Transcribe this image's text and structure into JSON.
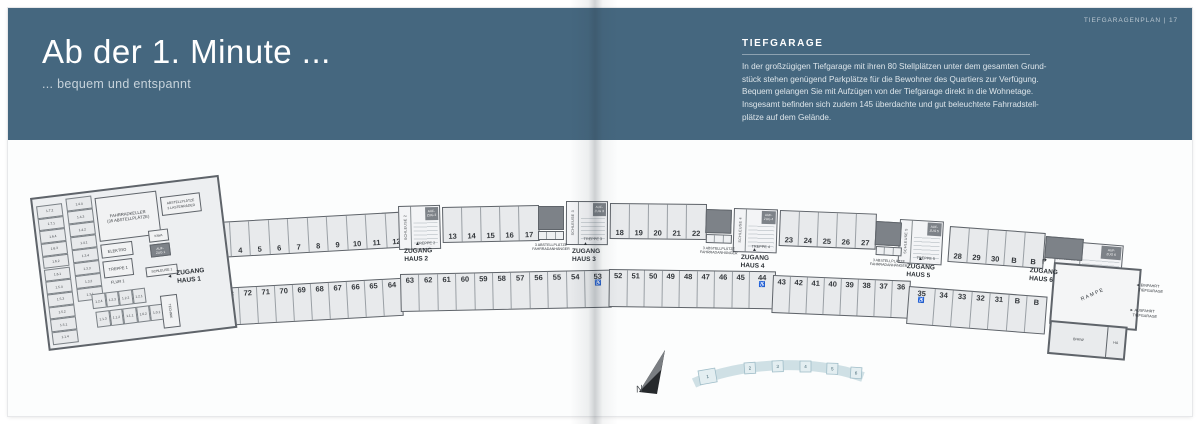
{
  "colors": {
    "header_bg": "#45677f",
    "wall": "#5f646a",
    "stall_fill": "#e8eaec",
    "dark_block": "#7d8288",
    "minimap_fill": "#e3eef1",
    "minimap_border": "#9fbdc8"
  },
  "header_left": {
    "title": "Ab der 1. Minute ...",
    "subtitle": "... bequem und entspannt"
  },
  "header_right": {
    "corner": "TIEFGARAGENPLAN | 17",
    "section_title": "TIEFGARAGE",
    "paragraph": [
      "In der großzügigen Tiefgarage mit ihren 80 Stellplätzen unter dem gesamten Grund-",
      "stück stehen genügend Parkplätze für die Bewohner des Quartiers zur Verfügung.",
      "Bequem gelangen Sie mit Aufzügen von der Tiefgarage direkt in die Wohnetage.",
      "Insgesamt befinden sich zudem 145 überdachte und gut beleuchtete Fahrradstell-",
      "plätze auf dem Gelände."
    ]
  },
  "plan": {
    "handicap": [
      "1",
      "53",
      "44",
      "35"
    ],
    "segments": [
      {
        "row": "top",
        "x": 163,
        "y": 225,
        "h": 36,
        "rot": -3.2,
        "sw": 19.5,
        "stalls": [
          "1",
          "2",
          "3",
          "4",
          "5",
          "6",
          "7",
          "8",
          "9",
          "10",
          "11",
          "12"
        ]
      },
      {
        "row": "top",
        "x": 442,
        "y": 207,
        "h": 36,
        "rot": -1.2,
        "sw": 19,
        "stalls": [
          "13",
          "14",
          "15",
          "16",
          "17"
        ]
      },
      {
        "row": "top",
        "x": 610,
        "y": 203,
        "h": 36,
        "rot": 0.6,
        "sw": 19,
        "stalls": [
          "18",
          "19",
          "20",
          "21",
          "22"
        ]
      },
      {
        "row": "top",
        "x": 780,
        "y": 210,
        "h": 36,
        "rot": 2.2,
        "sw": 19,
        "stalls": [
          "23",
          "24",
          "25",
          "26",
          "27"
        ]
      },
      {
        "row": "top",
        "x": 950,
        "y": 226,
        "h": 36,
        "rot": 4.2,
        "sw": 18.8,
        "stalls": [
          "28",
          "29",
          "30",
          "B",
          "B"
        ]
      },
      {
        "row": "bottom",
        "x": 166,
        "y": 291,
        "h": 38,
        "rot": -3.2,
        "sw": 18,
        "stalls": [
          "76",
          "75",
          "74",
          "73",
          "72",
          "71",
          "70",
          "69",
          "68",
          "67",
          "66",
          "65",
          "64"
        ]
      },
      {
        "row": "bottom",
        "x": 400,
        "y": 274,
        "h": 38,
        "rot": -1.2,
        "sw": 18.4,
        "stalls": [
          "63",
          "62",
          "61",
          "60",
          "59",
          "58",
          "57",
          "56",
          "55",
          "54",
          "53"
        ]
      },
      {
        "row": "bottom",
        "x": 609,
        "y": 269,
        "h": 38,
        "rot": 0.8,
        "sw": 17.5,
        "stalls": [
          "52",
          "51",
          "50",
          "49",
          "48",
          "47",
          "46",
          "45",
          "44"
        ]
      },
      {
        "row": "bottom",
        "x": 773,
        "y": 275,
        "h": 38,
        "rot": 2.4,
        "sw": 17,
        "stalls": [
          "43",
          "42",
          "41",
          "40",
          "39",
          "38",
          "37",
          "36"
        ]
      },
      {
        "row": "bottom",
        "x": 909,
        "y": 286,
        "h": 38,
        "rot": 4.4,
        "sw": 18.5,
        "stalls": [
          "35",
          "34",
          "33",
          "32",
          "31",
          "B",
          "B"
        ]
      }
    ],
    "cores": [
      {
        "x": 398,
        "y": 206,
        "w": 42,
        "h": 44,
        "rot": -1.5,
        "schleuse": "SCHLEUSE 2",
        "treppe": "TREPPE 2",
        "aufzug": "AUF-\nZUG 2",
        "horiz": false
      },
      {
        "x": 566,
        "y": 201,
        "w": 42,
        "h": 44,
        "rot": 0.2,
        "schleuse": "SCHLEUSE 3",
        "treppe": "TREPPE 3",
        "aufzug": "AUF-\nZUG 3",
        "horiz": false
      },
      {
        "x": 734,
        "y": 208,
        "w": 44,
        "h": 44,
        "rot": 1.8,
        "schleuse": "SCHLEUSE 4",
        "treppe": "TREPPE 4",
        "aufzug": "AUF-\nZUG 4",
        "horiz": false
      },
      {
        "x": 900,
        "y": 219,
        "w": 44,
        "h": 44,
        "rot": 3.2,
        "schleuse": "SCHLEUSE 5",
        "treppe": "TREPPE 5",
        "aufzug": "AUF-\nZUG 5",
        "horiz": false
      },
      {
        "x": 1056,
        "y": 240,
        "w": 68,
        "h": 36,
        "rot": 4.6,
        "schleuse": "SCHLEUSE 6",
        "treppe": "TREPPE 6",
        "aufzug": "AUF-\nZUG 6",
        "horiz": true
      }
    ],
    "dark_blocks": [
      {
        "x": 538,
        "y": 206,
        "w": 26,
        "h": 24,
        "rot": 0,
        "trailer": true
      },
      {
        "x": 706,
        "y": 209,
        "w": 26,
        "h": 24,
        "rot": 1.8,
        "trailer": true
      },
      {
        "x": 876,
        "y": 221,
        "w": 26,
        "h": 24,
        "rot": 3.2,
        "trailer": true
      },
      {
        "x": 1046,
        "y": 236,
        "w": 38,
        "h": 22,
        "rot": 4.6,
        "trailer": false
      }
    ],
    "labels": [
      {
        "t": "ZUGANG\nHAUS 1",
        "x": 176,
        "y": 270,
        "rot": -6,
        "fs": 6.5,
        "fw": 700
      },
      {
        "t": "◄",
        "x": 167,
        "y": 274,
        "rot": -6,
        "fs": 5,
        "fw": 400
      },
      {
        "t": "ZUGANG\nHAUS 2",
        "x": 404,
        "y": 248,
        "rot": -1.5,
        "fs": 6.5,
        "fw": 700
      },
      {
        "t": "▲",
        "x": 415,
        "y": 241,
        "rot": 0,
        "fs": 5,
        "fw": 400
      },
      {
        "t": "ZUGANG\nHAUS 3",
        "x": 572,
        "y": 248,
        "rot": 0,
        "fs": 6.5,
        "fw": 700
      },
      {
        "t": "▲",
        "x": 583,
        "y": 241,
        "rot": 0,
        "fs": 5,
        "fw": 400
      },
      {
        "t": "ZUGANG\nHAUS 4",
        "x": 741,
        "y": 254,
        "rot": 2,
        "fs": 6.5,
        "fw": 700
      },
      {
        "t": "▲",
        "x": 752,
        "y": 247,
        "rot": 0,
        "fs": 5,
        "fw": 400
      },
      {
        "t": "ZUGANG\nHAUS 5",
        "x": 907,
        "y": 263,
        "rot": 3.2,
        "fs": 6.5,
        "fw": 700
      },
      {
        "t": "▲",
        "x": 918,
        "y": 256,
        "rot": 0,
        "fs": 5,
        "fw": 400
      },
      {
        "t": "ZUGANG\nHAUS 6",
        "x": 1030,
        "y": 267,
        "rot": 4.6,
        "fs": 6.5,
        "fw": 700
      },
      {
        "t": "↱",
        "x": 1041,
        "y": 257,
        "rot": 0,
        "fs": 8,
        "fw": 700
      },
      {
        "t": "3 ABSTELLPLÄTZE\nFAHRRADANHÄNGER",
        "x": 551,
        "y": 243,
        "rot": 0,
        "fs": 3.6,
        "fw": 400,
        "center": true
      },
      {
        "t": "3 ABSTELLPLÄTZE\nFAHRRADANHÄNGER",
        "x": 719,
        "y": 246,
        "rot": 2,
        "fs": 3.6,
        "fw": 400,
        "center": true
      },
      {
        "t": "3 ABSTELLPLÄTZE\nFAHRRADANHÄNGER",
        "x": 889,
        "y": 258,
        "rot": 3.2,
        "fs": 3.6,
        "fw": 400,
        "center": true
      },
      {
        "t": "RAMPE",
        "x": 1080,
        "y": 297,
        "rot": -24,
        "fs": 5,
        "fw": 400,
        "ls": 1.5
      },
      {
        "t": "◄ EINFAHRT\n   TIEFGARAGE",
        "x": 1136,
        "y": 283,
        "rot": 4,
        "fs": 3.8,
        "fw": 400
      },
      {
        "t": "► AUSFAHRT\n   TIEFGARAGE",
        "x": 1130,
        "y": 308,
        "rot": 4,
        "fs": 3.8,
        "fw": 400
      }
    ],
    "keller": {
      "colA": [
        "1.7.2",
        "1.7.1",
        "1.6.4",
        "1.6.3",
        "1.6.2",
        "1.6.1",
        "1.5.4",
        "1.5.3",
        "1.5.2",
        "1.5.1",
        "1.1.4"
      ],
      "colB": [
        "1.4.4",
        "1.4.3",
        "1.4.2",
        "1.4.1",
        "1.3.4",
        "1.3.3",
        "1.3.2",
        "1.3.1"
      ],
      "rowC": [
        "1.2.4",
        "1.2.3",
        "1.2.2",
        "1.2.1"
      ],
      "rowD": [
        "1.1.3",
        "1.1.2",
        "1.1.1",
        "1.0.2",
        "1.0.1"
      ],
      "bike_room": "FAHRRADKELLER\n(35 ABSTELLPLÄTZE)",
      "lastenraeder": "ABSTELLPLÄTZE\n3 LASTENRÄDER",
      "elektro": "ELEKTRO",
      "kiwa": "KIWA",
      "aufzug": "AUF-\nZUG 1",
      "treppe": "TREPPE 1",
      "schleuse": "SCHLEUSE 1",
      "flur": "FLUR 1",
      "technik": "TECHNIK"
    },
    "ramp": {
      "rampe": "RAMPE",
      "bhkw": "BHKW",
      "ha": "HA"
    }
  },
  "minimap": {
    "north": "N",
    "houses": [
      "1",
      "2",
      "3",
      "4",
      "5",
      "6"
    ]
  }
}
